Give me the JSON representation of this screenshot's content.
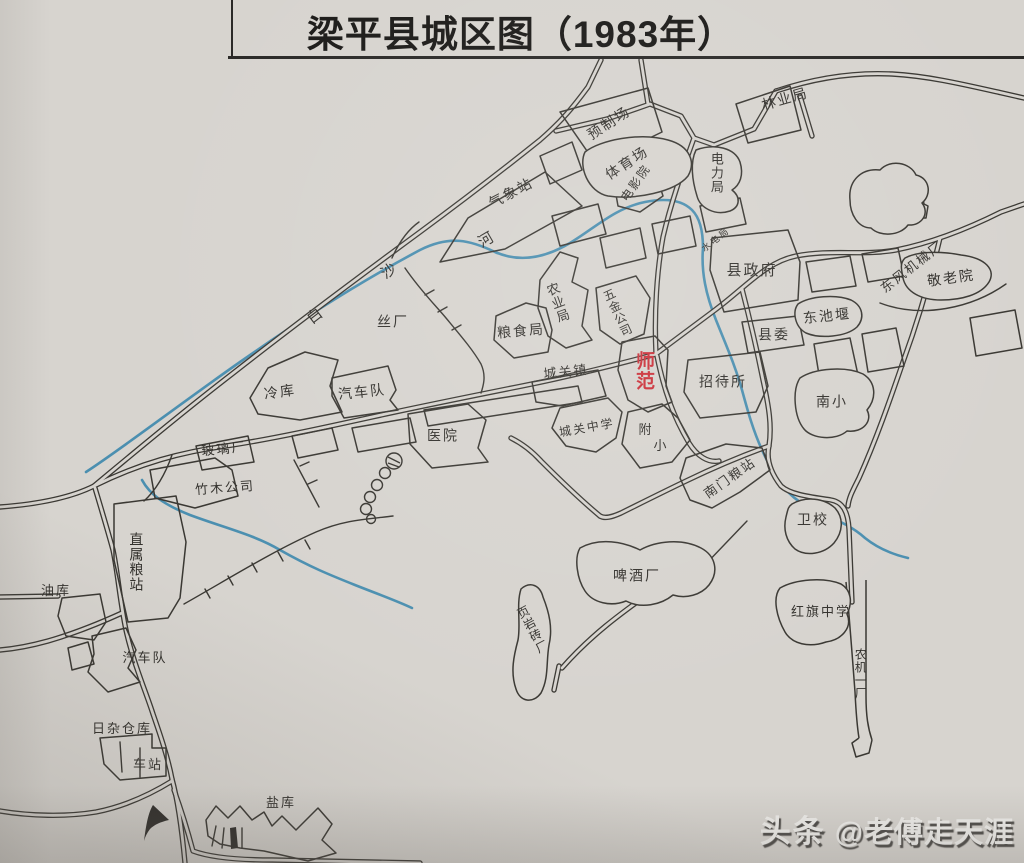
{
  "title": "梁平县城区图（1983年）",
  "river_name": "白沙河",
  "watermark": {
    "brand": "头条",
    "handle": "@老傅走天涯"
  },
  "colors": {
    "paper": "#d7d4cf",
    "ink": "#34322e",
    "river": "#4b8fb0",
    "red_highlight": "#cb3039",
    "watermark": "#eeedea"
  },
  "labels": [
    {
      "id": "weather-station",
      "text": "气象站",
      "x": 511,
      "y": 193,
      "rot": -28,
      "size": 14
    },
    {
      "id": "precast-yard",
      "text": "预制场",
      "x": 609,
      "y": 123,
      "rot": -33,
      "size": 14
    },
    {
      "id": "stadium",
      "text": "体育场",
      "x": 627,
      "y": 163,
      "rot": -33,
      "size": 14
    },
    {
      "id": "cinema",
      "text": "电影院",
      "x": 636,
      "y": 183,
      "rot": -55,
      "size": 12
    },
    {
      "id": "forestry-bureau",
      "text": "林业局",
      "x": 785,
      "y": 99,
      "rot": -16,
      "size": 14
    },
    {
      "id": "power-bureau",
      "text": "电力局",
      "x": 716,
      "y": 173,
      "rot": 0,
      "size": 13,
      "vertical": true
    },
    {
      "id": "hydropower-bureau",
      "text": "水电局",
      "x": 716,
      "y": 240,
      "rot": -38,
      "size": 9
    },
    {
      "id": "county-government",
      "text": "县政府",
      "x": 752,
      "y": 271,
      "rot": 0,
      "size": 15
    },
    {
      "id": "dongfeng-machinery-plant",
      "text": "东风机械厂",
      "x": 912,
      "y": 267,
      "rot": -38,
      "size": 13
    },
    {
      "id": "nursing-home",
      "text": "敬老院",
      "x": 951,
      "y": 278,
      "rot": -8,
      "size": 14
    },
    {
      "id": "dongchi-pond",
      "text": "东池堰",
      "x": 827,
      "y": 316,
      "rot": -6,
      "size": 14
    },
    {
      "id": "county-committee",
      "text": "县委",
      "x": 774,
      "y": 335,
      "rot": 0,
      "size": 14
    },
    {
      "id": "silk-factory",
      "text": "丝厂",
      "x": 393,
      "y": 322,
      "rot": 0,
      "size": 14
    },
    {
      "id": "grain-bureau",
      "text": "粮食局",
      "x": 521,
      "y": 331,
      "rot": -5,
      "size": 14
    },
    {
      "id": "agriculture-bureau",
      "text": "农业局",
      "x": 557,
      "y": 303,
      "rot": -20,
      "size": 13,
      "vertical": true
    },
    {
      "id": "hardware-company",
      "text": "五金公司",
      "x": 617,
      "y": 313,
      "rot": -25,
      "size": 12,
      "vertical": true
    },
    {
      "id": "normal-school",
      "text": "师范",
      "x": 643,
      "y": 371,
      "rot": 0,
      "size": 19,
      "vertical": true,
      "red": true
    },
    {
      "id": "chengguan-town",
      "text": "城关镇",
      "x": 566,
      "y": 372,
      "rot": -6,
      "size": 13
    },
    {
      "id": "guesthouse",
      "text": "招待所",
      "x": 723,
      "y": 382,
      "rot": 0,
      "size": 14
    },
    {
      "id": "south-primary-school",
      "text": "南小",
      "x": 832,
      "y": 402,
      "rot": 0,
      "size": 14
    },
    {
      "id": "cold-storage",
      "text": "冷库",
      "x": 280,
      "y": 392,
      "rot": -8,
      "size": 14
    },
    {
      "id": "motor-fleet-north",
      "text": "汽车队",
      "x": 362,
      "y": 392,
      "rot": -6,
      "size": 14
    },
    {
      "id": "hospital",
      "text": "医院",
      "x": 443,
      "y": 436,
      "rot": 0,
      "size": 14
    },
    {
      "id": "glass-factory",
      "text": "玻璃厂",
      "x": 224,
      "y": 449,
      "rot": -6,
      "size": 13
    },
    {
      "id": "bamboo-timber-company",
      "text": "竹木公司",
      "x": 225,
      "y": 488,
      "rot": -4,
      "size": 13
    },
    {
      "id": "chengguan-middle-school",
      "text": "城关中学",
      "x": 587,
      "y": 428,
      "rot": -10,
      "size": 12
    },
    {
      "id": "attached-primary-char1",
      "text": "附",
      "x": 646,
      "y": 430,
      "rot": 0,
      "size": 13
    },
    {
      "id": "attached-primary-char2",
      "text": "小",
      "x": 661,
      "y": 446,
      "rot": 0,
      "size": 13
    },
    {
      "id": "south-gate-grain-station",
      "text": "南门粮站",
      "x": 730,
      "y": 478,
      "rot": -35,
      "size": 13
    },
    {
      "id": "health-school",
      "text": "卫校",
      "x": 813,
      "y": 520,
      "rot": 0,
      "size": 14
    },
    {
      "id": "direct-grain-station",
      "text": "直属粮站",
      "x": 136,
      "y": 562,
      "rot": 0,
      "size": 14,
      "vertical": true
    },
    {
      "id": "oil-depot",
      "text": "油库",
      "x": 56,
      "y": 591,
      "rot": 0,
      "size": 13
    },
    {
      "id": "brewery",
      "text": "啤酒厂",
      "x": 637,
      "y": 576,
      "rot": 0,
      "size": 14
    },
    {
      "id": "hongqi-middle-school",
      "text": "红旗中学",
      "x": 821,
      "y": 612,
      "rot": 0,
      "size": 13
    },
    {
      "id": "shale-brick-factory",
      "text": "页岩砖厂",
      "x": 532,
      "y": 630,
      "rot": -28,
      "size": 12,
      "vertical": true
    },
    {
      "id": "motor-fleet-south",
      "text": "汽车队",
      "x": 145,
      "y": 658,
      "rot": 0,
      "size": 13
    },
    {
      "id": "agri-machinery-plant",
      "text": "农机一厂",
      "x": 860,
      "y": 674,
      "rot": 0,
      "size": 12,
      "vertical": true
    },
    {
      "id": "sundries-warehouse",
      "text": "日杂仓库",
      "x": 122,
      "y": 729,
      "rot": 0,
      "size": 13
    },
    {
      "id": "bus-station",
      "text": "车站",
      "x": 148,
      "y": 765,
      "rot": 0,
      "size": 13
    },
    {
      "id": "salt-depot",
      "text": "盐库",
      "x": 281,
      "y": 803,
      "rot": 0,
      "size": 13
    },
    {
      "id": "river-char-bai",
      "text": "白",
      "x": 316,
      "y": 316,
      "rot": -38,
      "size": 15
    },
    {
      "id": "river-char-sha",
      "text": "沙",
      "x": 390,
      "y": 271,
      "rot": -35,
      "size": 15
    },
    {
      "id": "river-char-he",
      "text": "河",
      "x": 487,
      "y": 240,
      "rot": -30,
      "size": 15
    }
  ]
}
